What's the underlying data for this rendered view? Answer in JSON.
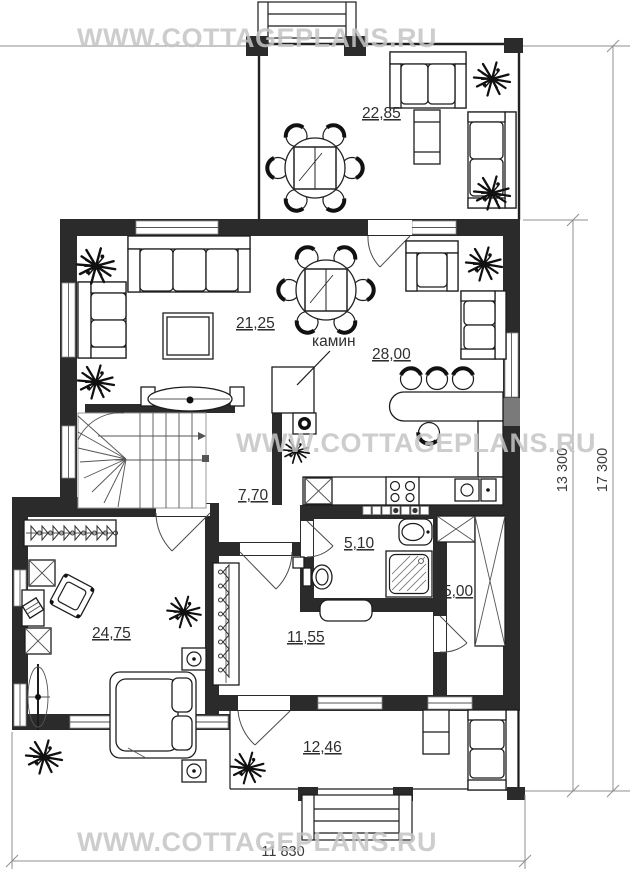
{
  "watermark": "WWW.COTTAGEPLANS.RU",
  "rooms": {
    "terrace_top": "22,85",
    "living_room": "21,25",
    "kitchen_dining": "28,00",
    "hall": "7,70",
    "bathroom": "5,10",
    "storage": "5,00",
    "bedroom": "24,75",
    "corridor": "11,55",
    "terrace_bottom": "12,46"
  },
  "annotations": {
    "fireplace": "камин"
  },
  "dimensions": {
    "overall_width": "11 830",
    "main_depth": "13 300",
    "overall_depth": "17 300"
  },
  "colors": {
    "wall": "#2b2b2b",
    "dimension": "#8f8f8f",
    "watermark": "#c5c5c5",
    "label": "#2e2e2e"
  }
}
